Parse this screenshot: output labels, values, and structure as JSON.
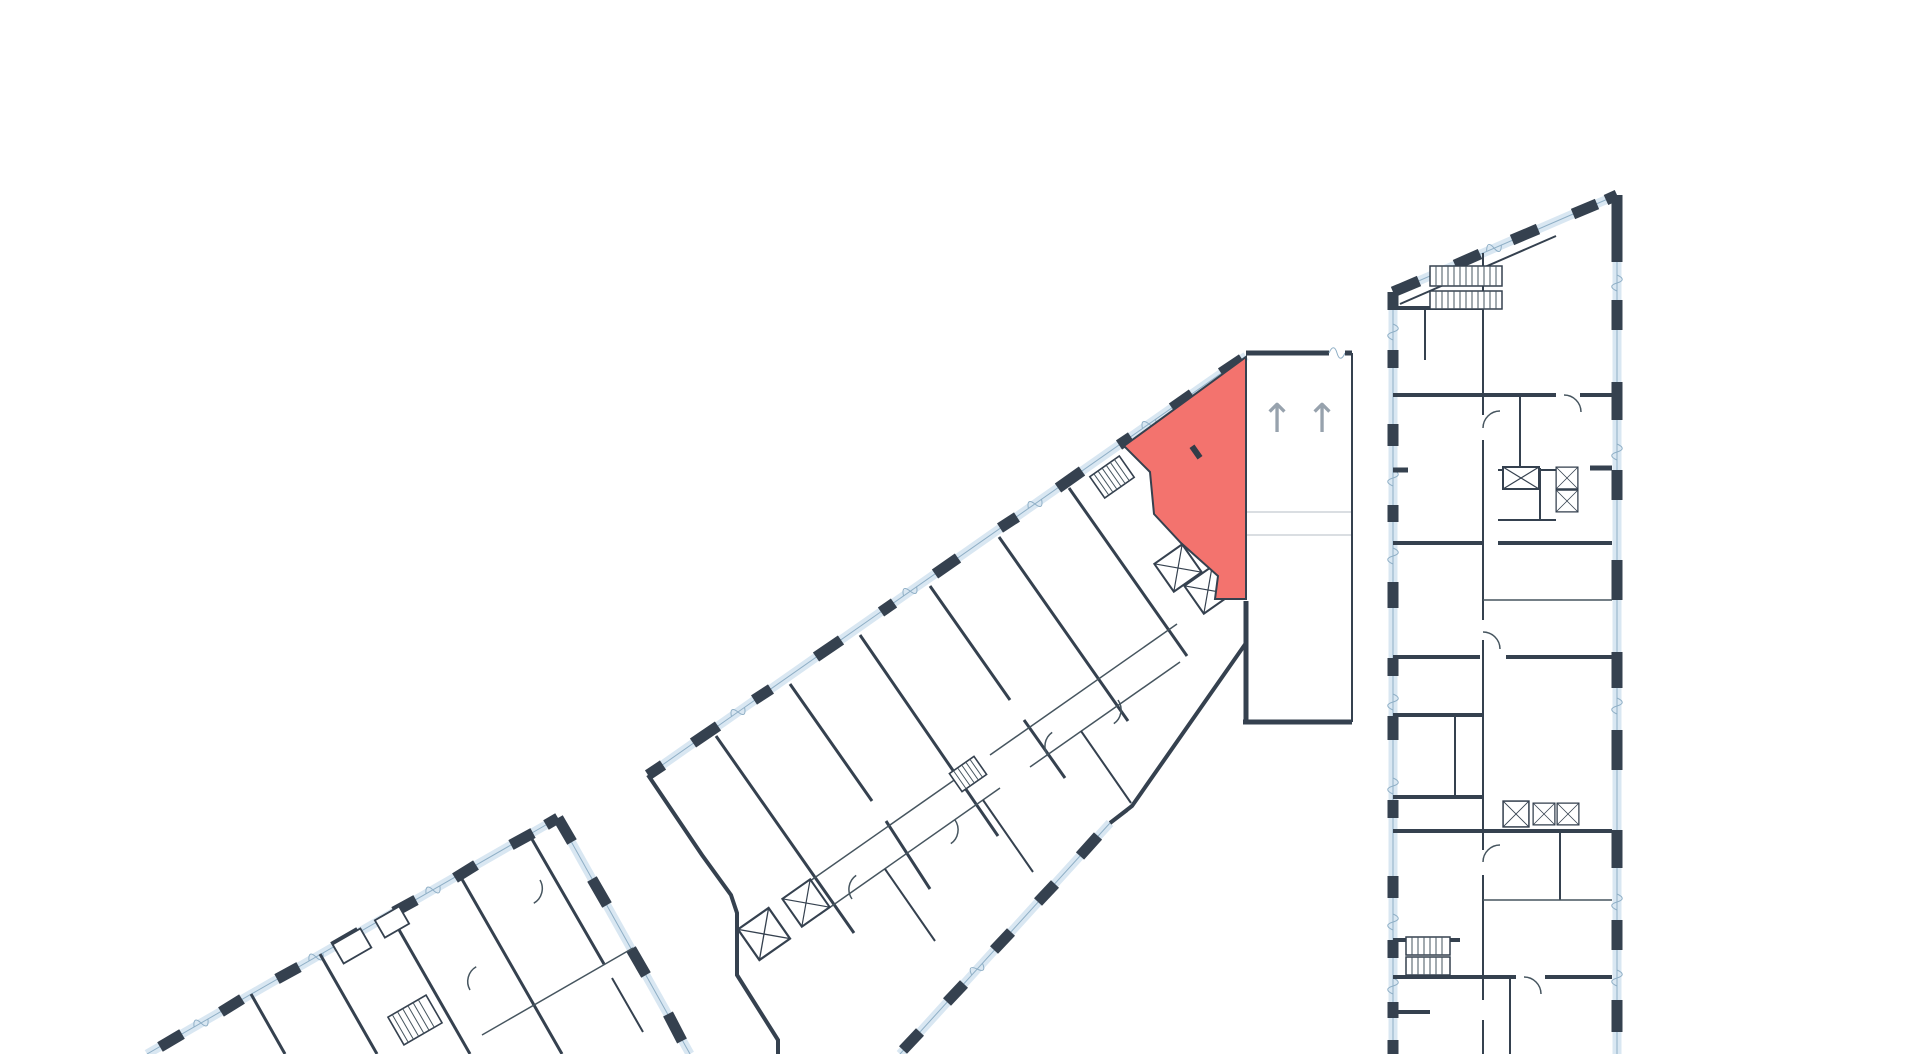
{
  "palette": {
    "background": "#ffffff",
    "wall": "#35414f",
    "wall_thin": "#46555f",
    "glass_fill": "#d9e7f2",
    "glass_edge": "#8fafc6",
    "divider_light": "#cdd3d9",
    "highlight_fill": "#f3736e",
    "highlight_marker": "#323c48",
    "arrow": "#97a2ad"
  },
  "floorplan": {
    "description": "Architectural floor plan with three building sections on a white background; one apartment unit in the middle diagonal building is highlighted in coral red next to an elevator core with two up arrows",
    "highlighted_unit": {
      "building": "middle-diagonal-building",
      "fill": "#f3736e",
      "state": "selected"
    },
    "buildings": [
      {
        "id": "bottom-left-building",
        "position": "bottom-left",
        "partially_visible": true
      },
      {
        "id": "middle-diagonal-building",
        "position": "center",
        "rotation_deg": -35,
        "has_highlighted_unit": true
      },
      {
        "id": "right-building",
        "position": "right",
        "partially_visible": true
      }
    ],
    "symbols": {
      "up_arrows": [
        {
          "glyph": "↑"
        },
        {
          "glyph": "↑"
        }
      ],
      "elevator_icon": "crossed-box",
      "stairs_icon": "hatched-treads",
      "window_icon": "light-blue-strip"
    }
  }
}
